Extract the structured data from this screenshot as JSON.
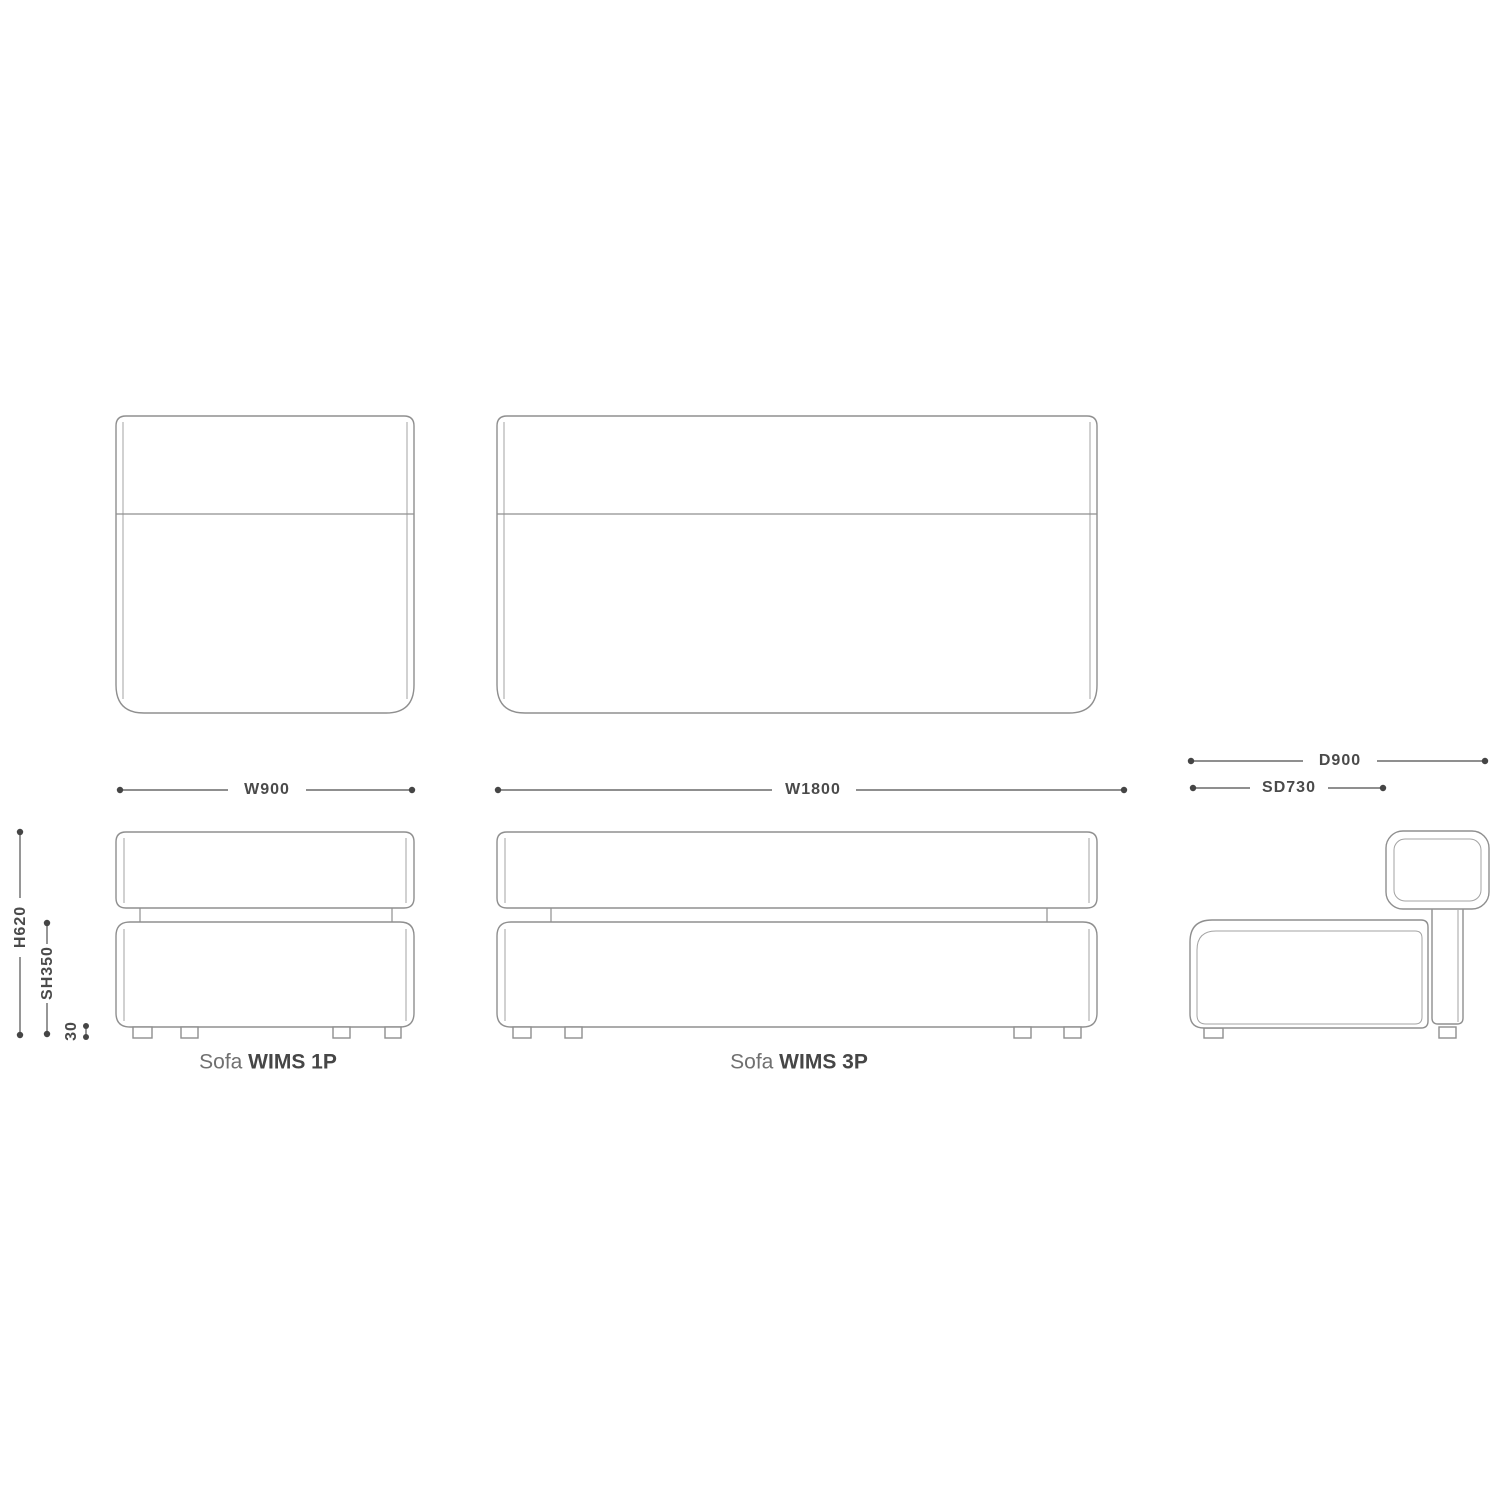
{
  "colors": {
    "bg": "#ffffff",
    "outline": "#8f8f8f",
    "outline_light": "#a3a3a3",
    "dim_line": "#6a6a6a",
    "dim_dot": "#454545",
    "dim_text": "#4a4a4a",
    "label_prefix": "#707070",
    "label_name": "#464646"
  },
  "products": {
    "sofa_1p": {
      "label_prefix": "Sofa",
      "label_name": "WIMS 1P",
      "width": "W900"
    },
    "sofa_3p": {
      "label_prefix": "Sofa",
      "label_name": "WIMS 3P",
      "width": "W1800"
    }
  },
  "side_profile": {
    "depth": "D900",
    "seat_depth": "SD730"
  },
  "heights": {
    "overall": "H620",
    "seat": "SH350",
    "leg": "30"
  }
}
